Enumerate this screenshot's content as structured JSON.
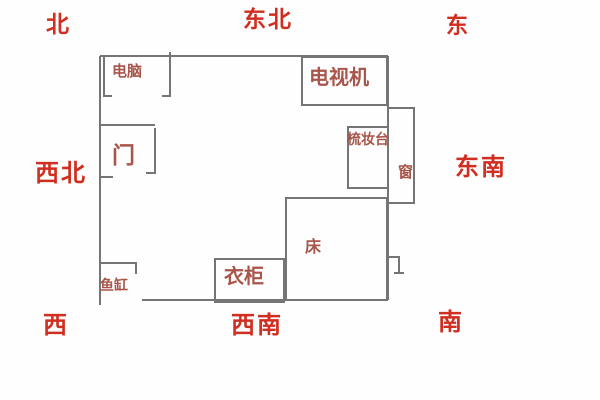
{
  "title": "bedroom-fengshui-floorplan",
  "colors": {
    "compass_red": "#cf2e20",
    "furniture_red": "#a8554a",
    "wall_gray": "#757575"
  },
  "compass": {
    "labels": [
      {
        "name": "north",
        "text": "北"
      },
      {
        "name": "northeast",
        "text": "东北"
      },
      {
        "name": "east",
        "text": "东"
      },
      {
        "name": "northwest",
        "text": "西北"
      },
      {
        "name": "southeast",
        "text": "东南"
      },
      {
        "name": "west",
        "text": "西"
      },
      {
        "name": "southwest",
        "text": "西南"
      },
      {
        "name": "south",
        "text": "南"
      }
    ]
  },
  "room": {
    "furniture": [
      {
        "name": "computer",
        "label": "电脑"
      },
      {
        "name": "tv",
        "label": "电视机"
      },
      {
        "name": "door",
        "label": "门"
      },
      {
        "name": "dressing-table",
        "label": "梳妆台"
      },
      {
        "name": "window",
        "label": "窗"
      },
      {
        "name": "bed",
        "label": "床"
      },
      {
        "name": "wardrobe",
        "label": "衣柜"
      },
      {
        "name": "fish-tank",
        "label": "鱼缸"
      }
    ]
  }
}
